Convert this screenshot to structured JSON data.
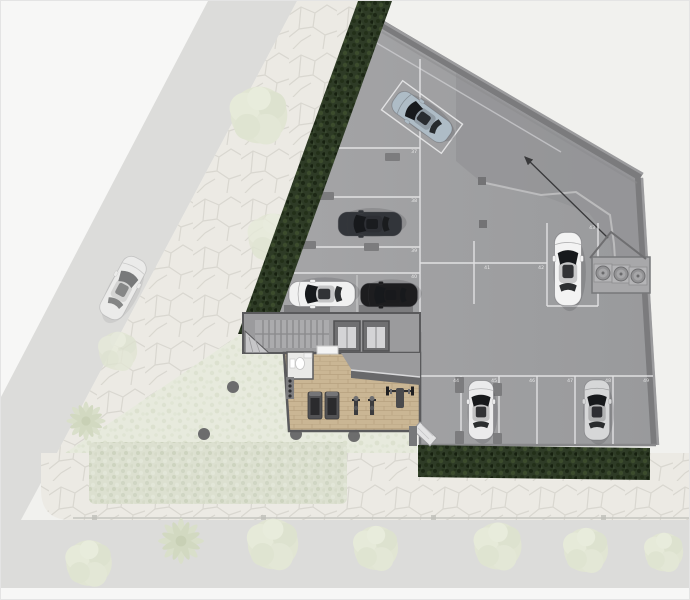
{
  "stalls": {
    "left_column": [
      "37",
      "38",
      "39",
      "40"
    ],
    "middle": [
      "41",
      "42",
      "43"
    ],
    "bottom_row": [
      "44",
      "45",
      "46",
      "47",
      "48",
      "49"
    ]
  },
  "cars": [
    {
      "name": "car-steel-blue-angled-stall",
      "color": "#aebcc6"
    },
    {
      "name": "suv-dark-west-stall",
      "color": "#32353a"
    },
    {
      "name": "car-white-west-stall",
      "color": "#f1f1f1"
    },
    {
      "name": "car-black-west-stall",
      "color": "#1d1d1f"
    },
    {
      "name": "car-white-east-stall",
      "color": "#f3f3f3"
    },
    {
      "name": "car-white-south-stall",
      "color": "#ebebec"
    },
    {
      "name": "car-silver-south-stall",
      "color": "#d6d7d8"
    },
    {
      "name": "car-white-street-faded",
      "color": "#fbfbfa"
    }
  ],
  "features": {
    "stair_core": "staircase with landing",
    "elevators": [
      "elevator-1",
      "elevator-2"
    ],
    "gym": [
      "treadmill",
      "treadmill",
      "elliptical",
      "elliptical",
      "bench-press",
      "dumbbell-rack",
      "wc-toilet",
      "counter"
    ],
    "equipment_pads": [
      "circle-pad-1",
      "circle-pad-2",
      "circle-pad-3"
    ],
    "ramp_arrow": "drive-direction-arrow",
    "garden_columns": 4
  },
  "colors": {
    "slab": "#a0a0a2",
    "wall": "#7b7b7d",
    "hedge": "#2e3b26",
    "wood_floor": "#cab694",
    "stall_line": "#e9e9ea",
    "faded_background": "#f1f1ee"
  }
}
